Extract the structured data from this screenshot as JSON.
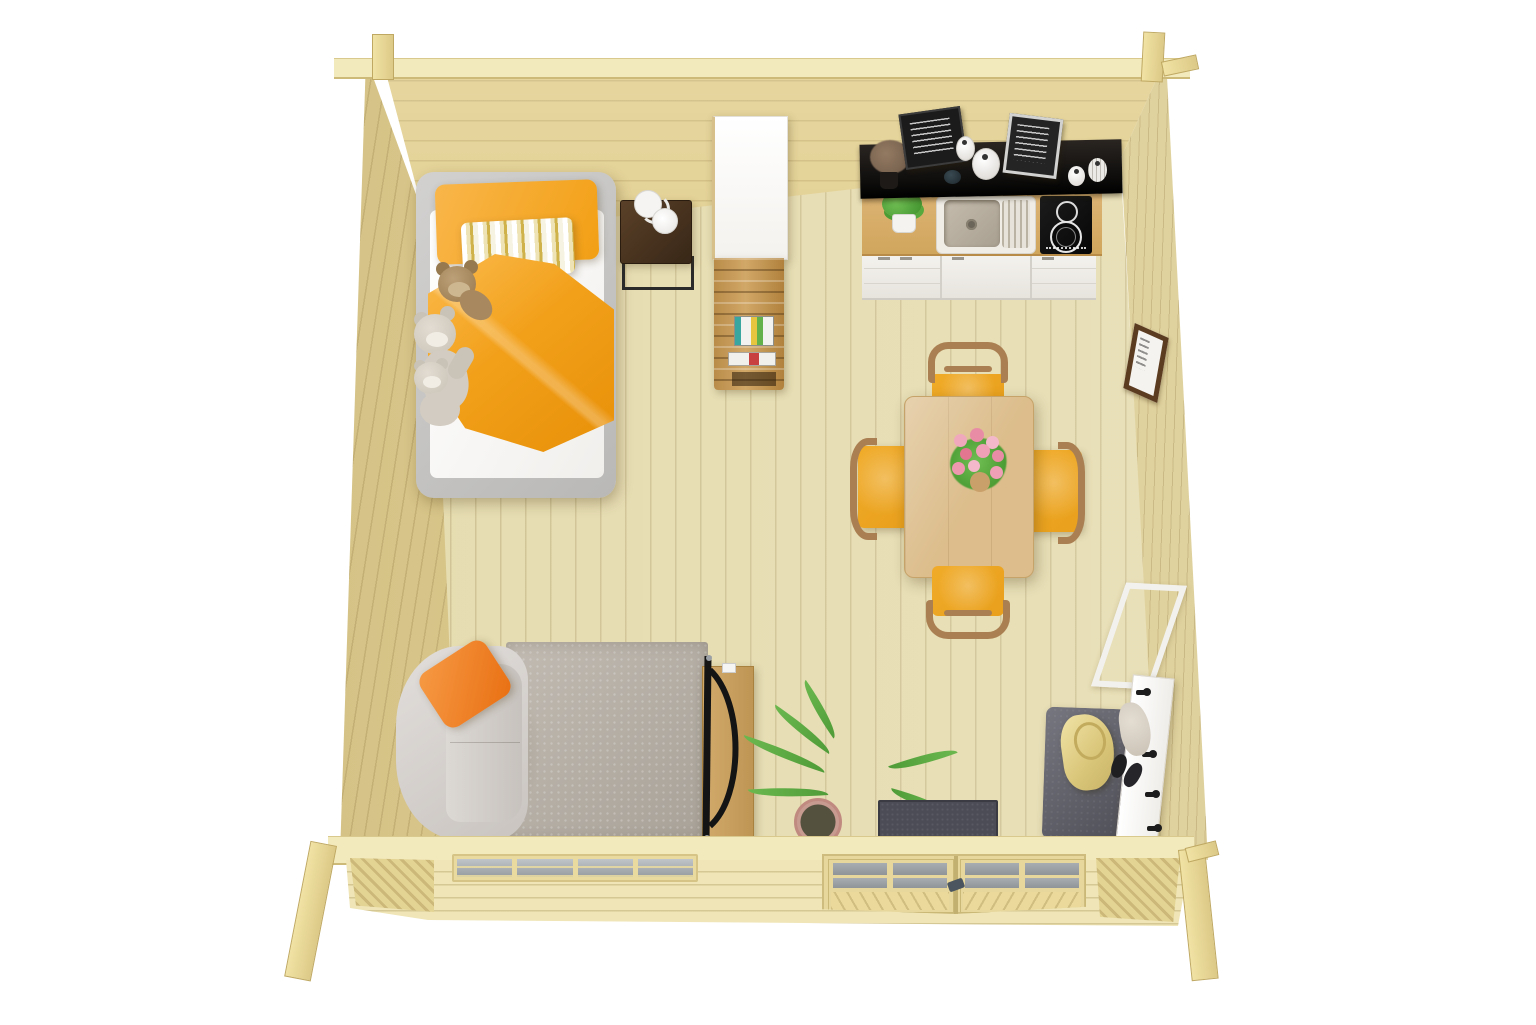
{
  "scene": {
    "title": "Log cabin studio interior — top-down 3D render",
    "background": "#ffffff"
  },
  "colors": {
    "wall-wood": "#e3d193",
    "wall-wood-light": "#e9dca8",
    "floor-wood": "#e6dcb0",
    "outer-wood": "#efe5b6",
    "ledge-wood": "#f2e9bd",
    "bed-frame": "#c7c6c4",
    "mattress": "#fcfbfa",
    "bedding-orange": "#f6a726",
    "stripe-gold": "#cfb24a",
    "teddy-brown": "#a98d66",
    "teddy-gray": "#d6d0c6",
    "nightstand": "#44301e",
    "white-furniture": "#fbfaf8",
    "shelf-wood": "#c9a164",
    "counter-wood": "#d9af6b",
    "shelf-black": "#191919",
    "sink-white": "#efece6",
    "basin": "#b5ac9e",
    "hob-black": "#101010",
    "cabinet-white": "#f0eeea",
    "table-wood": "#debf8d",
    "chair-wood": "#aa8052",
    "seat-orange": "#e9a01c",
    "flower-pink": "#ec9db4",
    "leaf-green": "#62b14a",
    "sofa-gray": "#d9d5d2",
    "pillow-orange": "#f08127",
    "rug-gray": "#b6afa5",
    "tv-black": "#141414",
    "plant-green": "#6cb84f",
    "pot-pink": "#c89b91",
    "mat-gray": "#4c4c56",
    "bench-gray": "#60606b",
    "bag-gold": "#e8d68c",
    "hook-black": "#1c1c1c",
    "frame-brown": "#5c3c20",
    "glass-gray": "#aab0b4"
  },
  "objects": {
    "cabin": {
      "label": "Log cabin top-down interior"
    },
    "floor": {
      "label": "Pine plank floor"
    },
    "walls": {
      "label": "Log walls"
    },
    "bed": {
      "label": "Single bed with orange bedding"
    },
    "pillow_orange": {
      "label": "Orange pillow"
    },
    "pillow_striped": {
      "label": "Striped pillow"
    },
    "blanket": {
      "label": "Orange duvet"
    },
    "teddy_brown": {
      "label": "Brown teddy bear"
    },
    "teddy_gray": {
      "label": "Gray teddy bear"
    },
    "teddy_small": {
      "label": "Small teddy bear"
    },
    "nightstand": {
      "label": "Dark wood nightstand"
    },
    "lamp": {
      "label": "White table lamp"
    },
    "wardrobe": {
      "label": "White wardrobe room divider"
    },
    "divider_shelf": {
      "label": "Wooden shelf with books"
    },
    "wall_shelf": {
      "label": "Black kitchen wall shelf"
    },
    "chalkboard_left": {
      "label": "Chalkboard coffee sign"
    },
    "chalkboard_right": {
      "label": "Framed chalkboard print"
    },
    "dried_bouquet": {
      "label": "Dried flower bouquet"
    },
    "vases": {
      "label": "White decorative vases"
    },
    "counter": {
      "label": "Kitchen counter"
    },
    "sink": {
      "label": "Kitchen sink with drainer"
    },
    "hob": {
      "label": "Two-zone hob"
    },
    "cabinets": {
      "label": "White kitchen cabinets"
    },
    "kitchen_plant": {
      "label": "Potted herb"
    },
    "dining_table": {
      "label": "Wooden dining table"
    },
    "dining_chair": {
      "label": "Dining chair with orange seat"
    },
    "bouquet": {
      "label": "Pink rose bouquet"
    },
    "wall_picture": {
      "label": "Small picture frame"
    },
    "sofa": {
      "label": "Gray sofa"
    },
    "sofa_pillow": {
      "label": "Orange cushion"
    },
    "rug": {
      "label": "Gray area rug"
    },
    "tv": {
      "label": "Flat TV"
    },
    "tv_bench": {
      "label": "Wooden TV bench"
    },
    "plant": {
      "label": "Potted green plant"
    },
    "doormat": {
      "label": "Dark doormat"
    },
    "entry_bench": {
      "label": "Gray entry bench"
    },
    "bag": {
      "label": "Gold bag"
    },
    "shoes": {
      "label": "Black shoes"
    },
    "coat_rack": {
      "label": "White coat rack with hooks"
    },
    "mirror": {
      "label": "White leaning mirror"
    },
    "window": {
      "label": "Four-pane window"
    },
    "door": {
      "label": "Glazed double door"
    }
  }
}
